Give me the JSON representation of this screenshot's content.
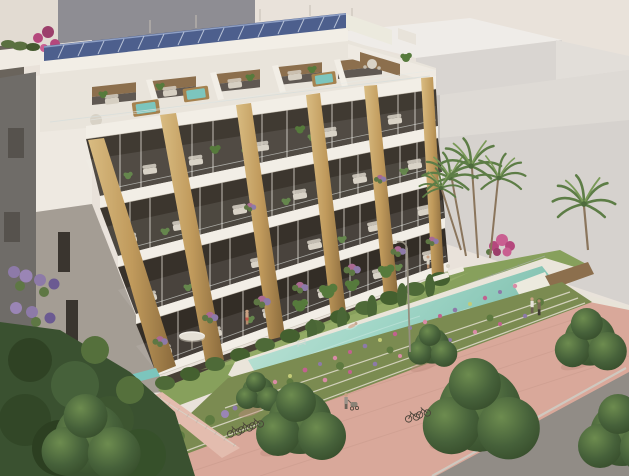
{
  "meta": {
    "title": "Aerial architectural rendering of a residential complex",
    "description": "3D render: modern white apartment building with golden stone pillars, rooftop solar panels and penthouse terraces with hot tubs; long turquoise lap pool on a lawn, terraced flower gardens, palm trees and a pink pedestrian promenade with trees, people and bicycles; large light-grey buildings in the background."
  },
  "palette": {
    "sky": "#e9e2da",
    "bg_block_top": "#efece8",
    "bg_block_front": "#d9d5d1",
    "bg_block_side": "#c8c4c0",
    "bg_block_tall": "#e2ded9",
    "topleft_wall": "#8e8d93",
    "topleft_stripe": "#b49aa6",
    "corner_wall": "#e2dbd2",
    "building_white": "#f2eee6",
    "penthouse_cream": "#e9e4db",
    "window_dark": "#3e3830",
    "stone": "#c09a5c",
    "stone_shadow": "#8a6a3c",
    "solar": "#4d5f8d",
    "wood": "#8c6f4d",
    "furniture": "#d6cfc2",
    "plant": "#567a3c",
    "hedge": "#4e6a38",
    "jacuzzi": "#7cc5bd",
    "lawn": "#87a05c",
    "lawn_light": "#9db36d",
    "deck": "#eae5da",
    "pool_light": "#c6e6da",
    "pool_deep": "#7fbfae",
    "flower_bed": "#7b8b51",
    "flower_pink": "#c2618f",
    "flower_purple": "#8d7aa8",
    "flower_rose": "#d98ba6",
    "flower_chartreuse": "#c3cb76",
    "promenade": "#d9a89a",
    "promenade_light": "#e3bcae",
    "road": "#918c86",
    "curb": "#cfc8bf",
    "tree": "#46613a",
    "tree_dark": "#324727",
    "tree_light": "#6d8c4f",
    "palm": "#5d7d46",
    "trunk": "#8a755c",
    "bougainvillea": "#b5487d",
    "side_wall": "#a49d94",
    "neighbor": "#6f6c68",
    "skin": "#c9a183",
    "swimsuit_red": "#c05548"
  },
  "scene": {
    "building": {
      "floors_visible": 6,
      "penthouse_hot_tubs": 3,
      "stone_pillars": 6,
      "has_solar_panels": true
    },
    "amenities": {
      "main_pool": 1,
      "plunge_pools": 2,
      "sun_loungers": 2,
      "parasols": 1
    },
    "environment": {
      "palm_trees": 5,
      "promenade_trees": 7,
      "people": 7,
      "bicycles": 5,
      "street_lamps": 1
    }
  }
}
